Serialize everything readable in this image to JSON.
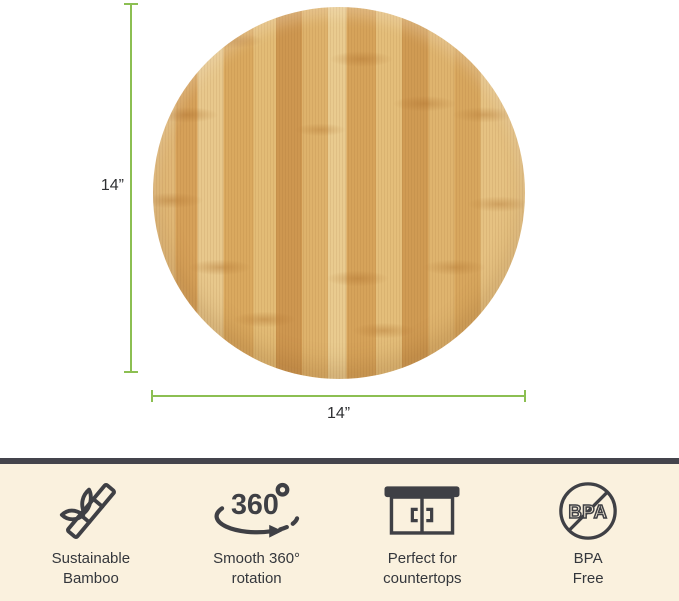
{
  "dimensions": {
    "height_label": "14”",
    "width_label": "14”"
  },
  "features": [
    {
      "icon": "bamboo-icon",
      "label": "Sustainable\nBamboo"
    },
    {
      "icon": "rotation-360-icon",
      "icon_text": "360",
      "label": "Smooth 360°\nrotation"
    },
    {
      "icon": "countertop-icon",
      "label": "Perfect for\ncountertops"
    },
    {
      "icon": "bpa-free-icon",
      "icon_text": "BPA",
      "label": "BPA\nFree"
    }
  ],
  "colors": {
    "dimension_line": "#8CBF52",
    "feature_bar_bg": "#FAF1DE",
    "feature_bar_top_strip": "#44444C",
    "icon_ink": "#3F4045",
    "wood_light": "#E8C88C",
    "wood_dark": "#CE9750"
  }
}
